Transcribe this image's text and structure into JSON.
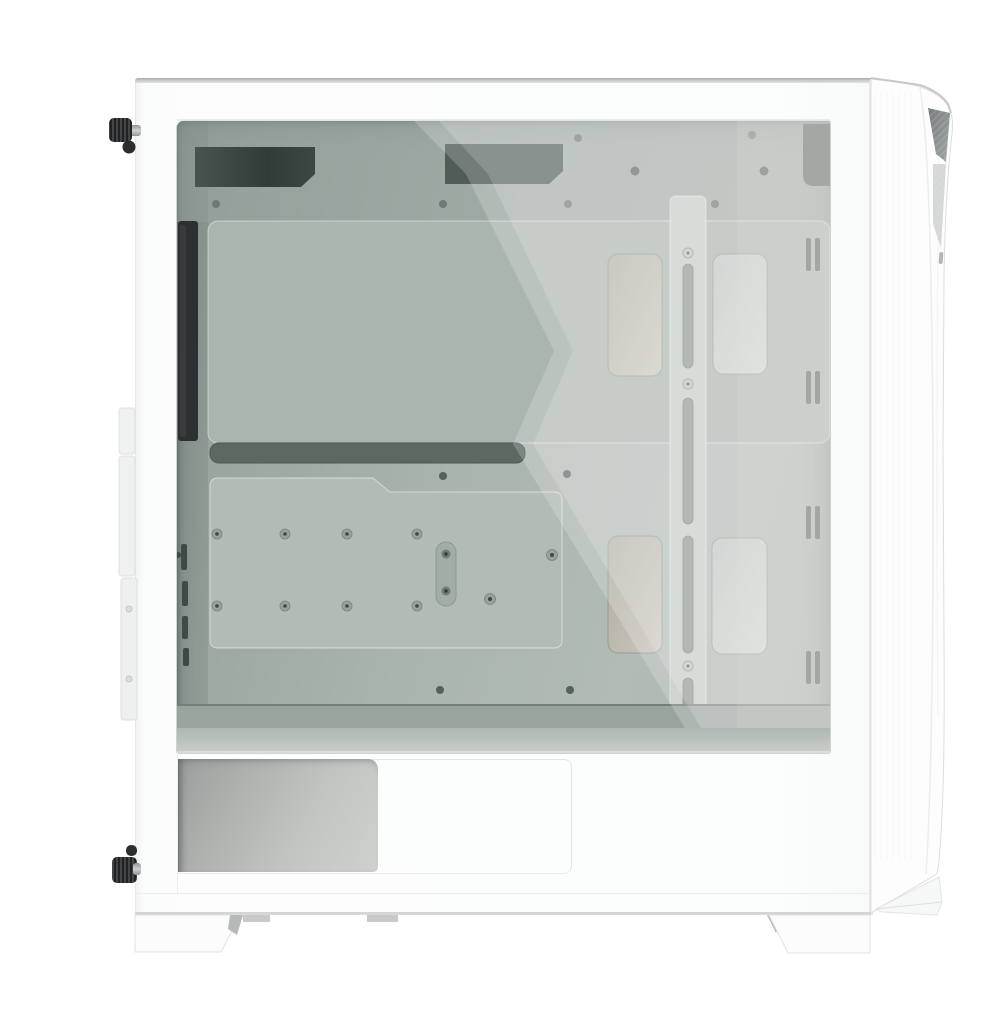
{
  "meta": {
    "type": "product-photograph",
    "description": "Studio product photo on a plain white background: left-side view of a white mid-tower ATX PC case with a tinted tempered-glass side panel. The greenish-tinted glass reveals an all-white interior: motherboard tray with cable grommets, a vertical cable-management bar with routing slots, standoff screws, ventilation cutouts, a black rear fan edge, and a white power-supply shroud with a silver PSU visible through a bottom cutout. The angled white front panel with a small dark mesh accent protrudes on the right; black thumbscrews protrude on the rear (left) edge; angular white feet at the bottom.",
    "background": "pure white",
    "dimensions": {
      "width": 1000,
      "height": 1000
    }
  },
  "scene": {
    "product": "White mid-tower PC case with tempered glass side panel, left-side view",
    "orientation": {
      "left_edge": "rear of case",
      "right_edge": "front panel",
      "bottom": "case feet"
    },
    "parts": {
      "pc-case": "Complete white PC tower case",
      "top-panel-edge": "Thin gray visible edge of the top panel",
      "side-panel-frame": "White painted frame of the side panel surrounding the glass",
      "tempered-glass-window": "Green-tinted tempered glass window with diagonal light reflection",
      "rear-fan-strip": "Black rear exhaust fan edge seen through glass",
      "top-vent-cutout": "Dark ventilation cutouts along top of motherboard tray",
      "motherboard-tray-panel": "Large white motherboard tray panel",
      "cable-routing-slot": "Dark horizontal cable routing slot below motherboard tray",
      "ssd-mount-plate": "Lower mounting plate with standoff screws",
      "standoff-screw": "Silver standoff screws in two rows",
      "cable-bar": "Vertical cable management bar with stadium-shaped slots",
      "cable-grommet": "Light rectangular cable pass-through cutouts",
      "cable-tie-slot": "Paired vertical cable tie slots near front edge",
      "rear-slot-vents": "Small vertical vent slots at rear column",
      "psu-shroud": "White power supply shroud across the bottom",
      "psu-silver-body": "Silver PSU / drive cage visible through shroud cutout",
      "front-panel": "Angled white front panel protruding at right",
      "front-mesh-wedge": "Dark gray triangular mesh intake accent near top of front panel",
      "thumbscrew-top": "Black knurled thumbscrew, rear top",
      "thumbscrew-bottom": "Black knurled thumbscrew, rear bottom",
      "rear-tab": "White brackets protruding from rear edge",
      "rear-foot": "Angular white foot under rear",
      "front-foot": "Angular white foot under front",
      "foot-clip": "Small gray dust-filter clips between feet",
      "glass-reflection": "Diagonal white sheen across the glass"
    }
  },
  "colors": {
    "background": "#ffffff",
    "case_white": "#fcfdfd",
    "top_edge_gray": "#a9abac",
    "glass_tint_dark": "#8e9a95",
    "glass_tint_light": "#b2bbb5",
    "interior_panel": "#abb5b0",
    "vent_dark": "#39433f",
    "fan_black": "#2c3032",
    "psu_silver": "#b7b9b7",
    "mesh_gray": "#868b8d",
    "thumbscrew_black": "#202223",
    "foot_pad_gray": "#b6b9b9",
    "seam_gray": "#e4e6e5"
  }
}
